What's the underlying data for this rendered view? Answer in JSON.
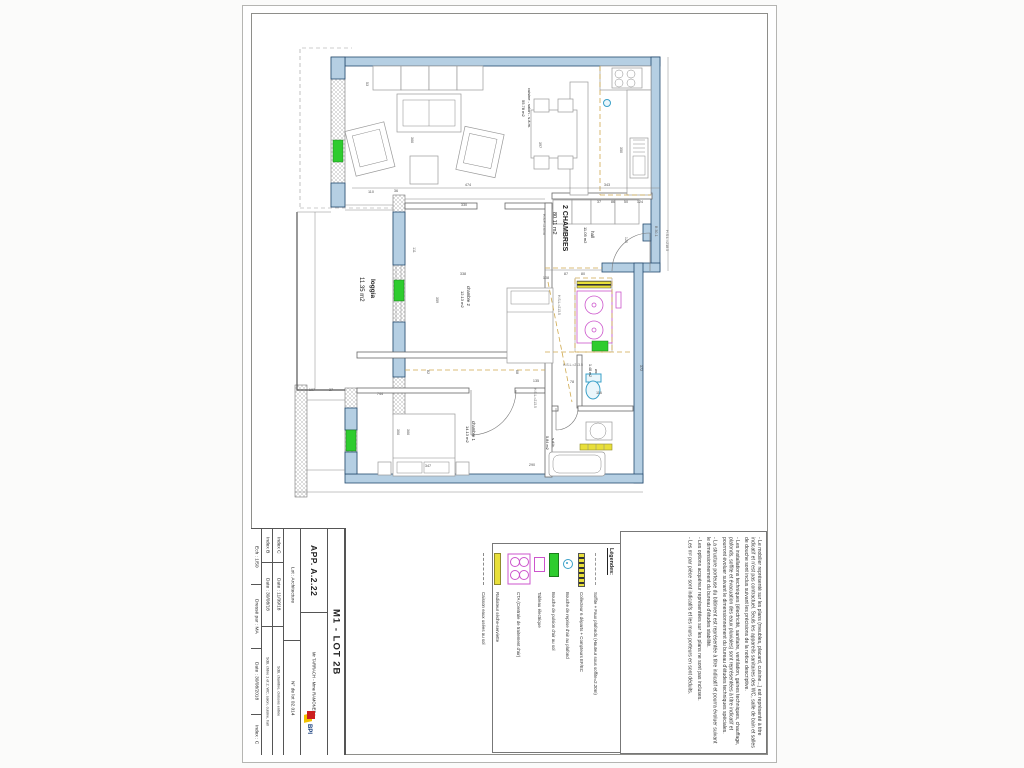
{
  "title_block": {
    "ech": {
      "scale": "Ech : 1/50",
      "drawn_by": "Dressé par : MA",
      "date": "Date : 30/08/2018",
      "index": "Index : C"
    },
    "index_b": {
      "name": "Index B",
      "date": "Date : 30/08/18",
      "desc": "SdB, chbre 1 et 2, WC, salon, cuisine, hall"
    },
    "index_c": {
      "name": "Index C",
      "date": "Date : 11/09/18",
      "desc": "SdB, chambre, cloisons entrée"
    },
    "lot": {
      "name": "Lot : Architecture",
      "num": "N° de lot 02.014"
    },
    "apartment": {
      "ref": "APP. A.2.22",
      "client": "Mr TARRACH - Mme RAMONEDA"
    },
    "sheet_ref": "M1 - LOT 2B",
    "logo_text": "BPI"
  },
  "legend": {
    "header": "Légendes:",
    "items": [
      {
        "icon": "soffite-dash-icon",
        "label": "Soffite + Faux plafonds (Hauteur sous soffite=2.20m)"
      },
      {
        "icon": "collecteur-bar-icon",
        "label": "Collecteur 6 départs + Compteurs EF/EC"
      },
      {
        "icon": "reprise-circle-icon",
        "label": "Bouche de reprise d'air au plafond"
      },
      {
        "icon": "pulsion-rect-icon",
        "label": "Bouche de pulsion d'air au sol"
      },
      {
        "icon": "tableau-rect-icon",
        "label": "Tableau électrique"
      },
      {
        "icon": "cta-box-icon",
        "label": "CTA (Centrale de traitement d'air)"
      },
      {
        "icon": "radiateur-bar-icon",
        "label": "Radiateur sèche-serviette"
      },
      {
        "icon": "caisson-dash-icon",
        "label": "Caisson eaux usées au sol"
      }
    ]
  },
  "notes": [
    "- Le mobilier représenté sur les plans (meubles, placard, cuisine...) est représenté à titre indicatif et n'est pas contractuel. Seuls les appareils sanitaires des WC, salle de bain et salles de douche sont inclus suivant les précisions de la notice descriptive.",
    "- Les installations techniques (électricité, sanitaire, ventilation, gaines techniques, chauffage, plafonds, soffite et évacuation des eaux pluviales) sont représentées à titre indicatif et pourront évoluer suivant le dimensionnement du bureau d'études techniques spéciales.",
    "- La structure porteuse du bâtiment est représentée à titre indicatif et pourra évoluer suivant le dimensionnement du bureau d'études stabilité.",
    "- Les options acquéreur représentées sur les plans ne sont pas incluses.",
    "- Les m² par pièce sont indicatifs et les murs porteurs en sont déduits."
  ],
  "plan": {
    "room_labels": [
      {
        "t": "2 CHAMBRES",
        "x": 563,
        "y": 205,
        "o": "v",
        "s": 7,
        "b": true
      },
      {
        "t": "80.11 m2",
        "x": 553,
        "y": 212,
        "o": "v",
        "s": 5.5
      },
      {
        "t": "hall",
        "x": 591,
        "y": 231,
        "o": "v",
        "s": 4.5
      },
      {
        "t": "11.05 m2",
        "x": 584,
        "y": 227,
        "o": "v",
        "s": 4
      },
      {
        "t": "cuisine - salon - s.à.m.",
        "x": 528,
        "y": 88,
        "o": "v",
        "s": 4
      },
      {
        "t": "55.78 m2",
        "x": 522,
        "y": 100,
        "o": "v",
        "s": 4
      },
      {
        "t": "chambre 2",
        "x": 467,
        "y": 286,
        "o": "v",
        "s": 4.2
      },
      {
        "t": "12.13 m2",
        "x": 461,
        "y": 291,
        "o": "v",
        "s": 4
      },
      {
        "t": "chambre 1",
        "x": 472,
        "y": 421,
        "o": "v",
        "s": 4.2
      },
      {
        "t": "14.13 m2",
        "x": 466,
        "y": 426,
        "o": "v",
        "s": 4
      },
      {
        "t": "loggia",
        "x": 371,
        "y": 279,
        "o": "v",
        "s": 6.5,
        "b": true
      },
      {
        "t": "11.35 m2",
        "x": 360,
        "y": 277,
        "o": "v",
        "s": 6
      },
      {
        "t": "wc",
        "x": 595,
        "y": 369,
        "o": "v",
        "s": 3.8
      },
      {
        "t": "1.48 m2",
        "x": 589,
        "y": 364,
        "o": "v",
        "s": 3.6
      },
      {
        "t": "s.d.b.",
        "x": 552,
        "y": 438,
        "o": "v",
        "s": 4
      },
      {
        "t": "5.84 m2",
        "x": 546,
        "y": 436,
        "o": "v",
        "s": 3.8
      }
    ],
    "dimensions": [
      {
        "t": "53",
        "x": 366,
        "y": 84,
        "o": "v"
      },
      {
        "t": "110",
        "x": 371,
        "y": 193
      },
      {
        "t": "36",
        "x": 396,
        "y": 192
      },
      {
        "t": "474",
        "x": 468,
        "y": 186
      },
      {
        "t": "343",
        "x": 607,
        "y": 186
      },
      {
        "t": "350",
        "x": 620,
        "y": 150,
        "o": "v"
      },
      {
        "t": "397",
        "x": 539,
        "y": 145,
        "o": "v"
      },
      {
        "t": "366",
        "x": 411,
        "y": 140,
        "o": "v"
      },
      {
        "t": "330",
        "x": 464,
        "y": 206
      },
      {
        "t": "111",
        "x": 413,
        "y": 250,
        "o": "v"
      },
      {
        "t": "338",
        "x": 463,
        "y": 275
      },
      {
        "t": "359",
        "x": 436,
        "y": 300,
        "o": "v"
      },
      {
        "t": "108",
        "x": 546,
        "y": 279
      },
      {
        "t": "87",
        "x": 566,
        "y": 275
      },
      {
        "t": "80",
        "x": 583,
        "y": 275
      },
      {
        "t": "37",
        "x": 599,
        "y": 203
      },
      {
        "t": "86",
        "x": 613,
        "y": 203
      },
      {
        "t": "50",
        "x": 626,
        "y": 203
      },
      {
        "t": "124",
        "x": 640,
        "y": 203
      },
      {
        "t": "120",
        "x": 625,
        "y": 240,
        "o": "v"
      },
      {
        "t": "107",
        "x": 312,
        "y": 391
      },
      {
        "t": "37",
        "x": 331,
        "y": 391
      },
      {
        "t": "744",
        "x": 380,
        "y": 395
      },
      {
        "t": "306",
        "x": 397,
        "y": 432,
        "o": "v"
      },
      {
        "t": "366",
        "x": 407,
        "y": 432,
        "o": "v"
      },
      {
        "t": "347",
        "x": 428,
        "y": 467
      },
      {
        "t": "135",
        "x": 536,
        "y": 382
      },
      {
        "t": "78",
        "x": 572,
        "y": 383
      },
      {
        "t": "116",
        "x": 599,
        "y": 394
      },
      {
        "t": "290",
        "x": 532,
        "y": 466
      },
      {
        "t": "372",
        "x": 640,
        "y": 368,
        "o": "v"
      },
      {
        "t": "82",
        "x": 427,
        "y": 372,
        "o": "v"
      },
      {
        "t": "68",
        "x": 516,
        "y": 372,
        "o": "v"
      }
    ],
    "annotations": [
      {
        "t": "H.S.L.=218.5",
        "x": 666,
        "y": 230,
        "o": "v",
        "s": 3.6
      },
      {
        "t": "B 30-1",
        "x": 655,
        "y": 226,
        "o": "v",
        "s": 3.6
      },
      {
        "t": "H.S.L.=213.5",
        "x": 558,
        "y": 295,
        "o": "v",
        "s": 3.4
      },
      {
        "t": "H.S.L.=213.5",
        "x": 534,
        "y": 388,
        "o": "v",
        "s": 3.4
      },
      {
        "t": "H.S.L.=213.5",
        "x": 563,
        "y": 366,
        "s": 3.4
      },
      {
        "t": "H.S.P.=2.60m",
        "x": 543,
        "y": 214,
        "o": "v",
        "s": 3.4
      }
    ]
  },
  "colors": {
    "wall_fill": "#b5cfe3",
    "wall_stroke": "#24496e",
    "window_green": "#2ecc2e",
    "tech_magenta": "#cc55cc",
    "radiator_yellow": "#e8df3a",
    "soffite_tan": "#cfa94e",
    "air_blue": "#3aa0c8"
  }
}
